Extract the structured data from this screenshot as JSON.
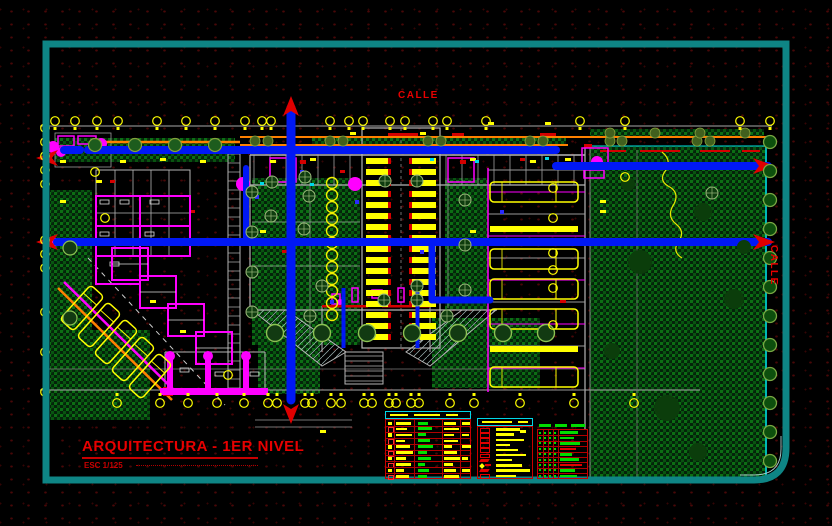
{
  "labels": {
    "street_top": "CALLE",
    "street_right": "CALLE"
  },
  "title_block": {
    "title": "ARQUITECTURA - 1ER NIVEL",
    "scale": "ESC 1/125"
  },
  "palette": {
    "frame_teal": "#0e8585",
    "cad_yellow": "#ffff00",
    "cad_magenta": "#ff00ff",
    "route_blue": "#0018f5",
    "cad_red": "#e80000",
    "cad_orange": "#ff8000",
    "cad_cyan": "#00d8e8",
    "vegetation_green": "#0c6e14",
    "wall_gray": "#b5b5b5"
  },
  "legend": {
    "materials_table": {
      "x": 385,
      "y": 411,
      "w": 86,
      "h": 68,
      "header_dashes": [
        18,
        26,
        12
      ],
      "rows": [
        {
          "c1": 15,
          "g": 10,
          "c3": 12,
          "c4": 8
        },
        {
          "c1": 11,
          "g": 14,
          "c3": 15,
          "c4": 0
        },
        {
          "c1": 16,
          "g": 8,
          "c3": 10,
          "c4": 7
        },
        {
          "c1": 9,
          "g": 12,
          "c3": 14,
          "c4": 0
        },
        {
          "c1": 14,
          "g": 15,
          "c3": 8,
          "c4": 9
        },
        {
          "c1": 17,
          "g": 9,
          "c3": 13,
          "c4": 0
        },
        {
          "c1": 10,
          "g": 13,
          "c3": 16,
          "c4": 6
        },
        {
          "c1": 15,
          "g": 7,
          "c3": 9,
          "c4": 0
        },
        {
          "c1": 8,
          "g": 11,
          "c3": 12,
          "c4": 8
        },
        {
          "c1": 13,
          "g": 9,
          "c3": 15,
          "c4": 0
        }
      ]
    },
    "doors_table": {
      "x": 477,
      "y": 418,
      "w": 56,
      "h": 61,
      "header_dashes": [
        30,
        10
      ],
      "rows": [
        {
          "w": 24,
          "glyph": "rect"
        },
        {
          "w": 18,
          "glyph": "rect"
        },
        {
          "w": 28,
          "glyph": "rect"
        },
        {
          "w": 14,
          "glyph": "rect"
        },
        {
          "w": 22,
          "glyph": "rect"
        },
        {
          "w": 30,
          "glyph": "rect"
        },
        {
          "w": 16,
          "glyph": "slant"
        },
        {
          "w": 26,
          "glyph": "star"
        },
        {
          "w": 34,
          "glyph": "slant"
        },
        {
          "w": 20,
          "glyph": "rect"
        }
      ]
    },
    "finishes_table": {
      "x": 537,
      "y": 423,
      "w": 51,
      "h": 56,
      "header_dashes": [
        12,
        12,
        14
      ],
      "rows": [
        {
          "main": "g",
          "w": 18
        },
        {
          "main": "g",
          "w": 14
        },
        {
          "main": "g",
          "w": 20
        },
        {
          "main": "r",
          "w": 16
        },
        {
          "main": "g",
          "w": 12
        },
        {
          "main": "g",
          "w": 19
        },
        {
          "main": "r",
          "w": 22
        },
        {
          "main": "g",
          "w": 15
        },
        {
          "main": "g",
          "w": 17
        }
      ]
    }
  }
}
